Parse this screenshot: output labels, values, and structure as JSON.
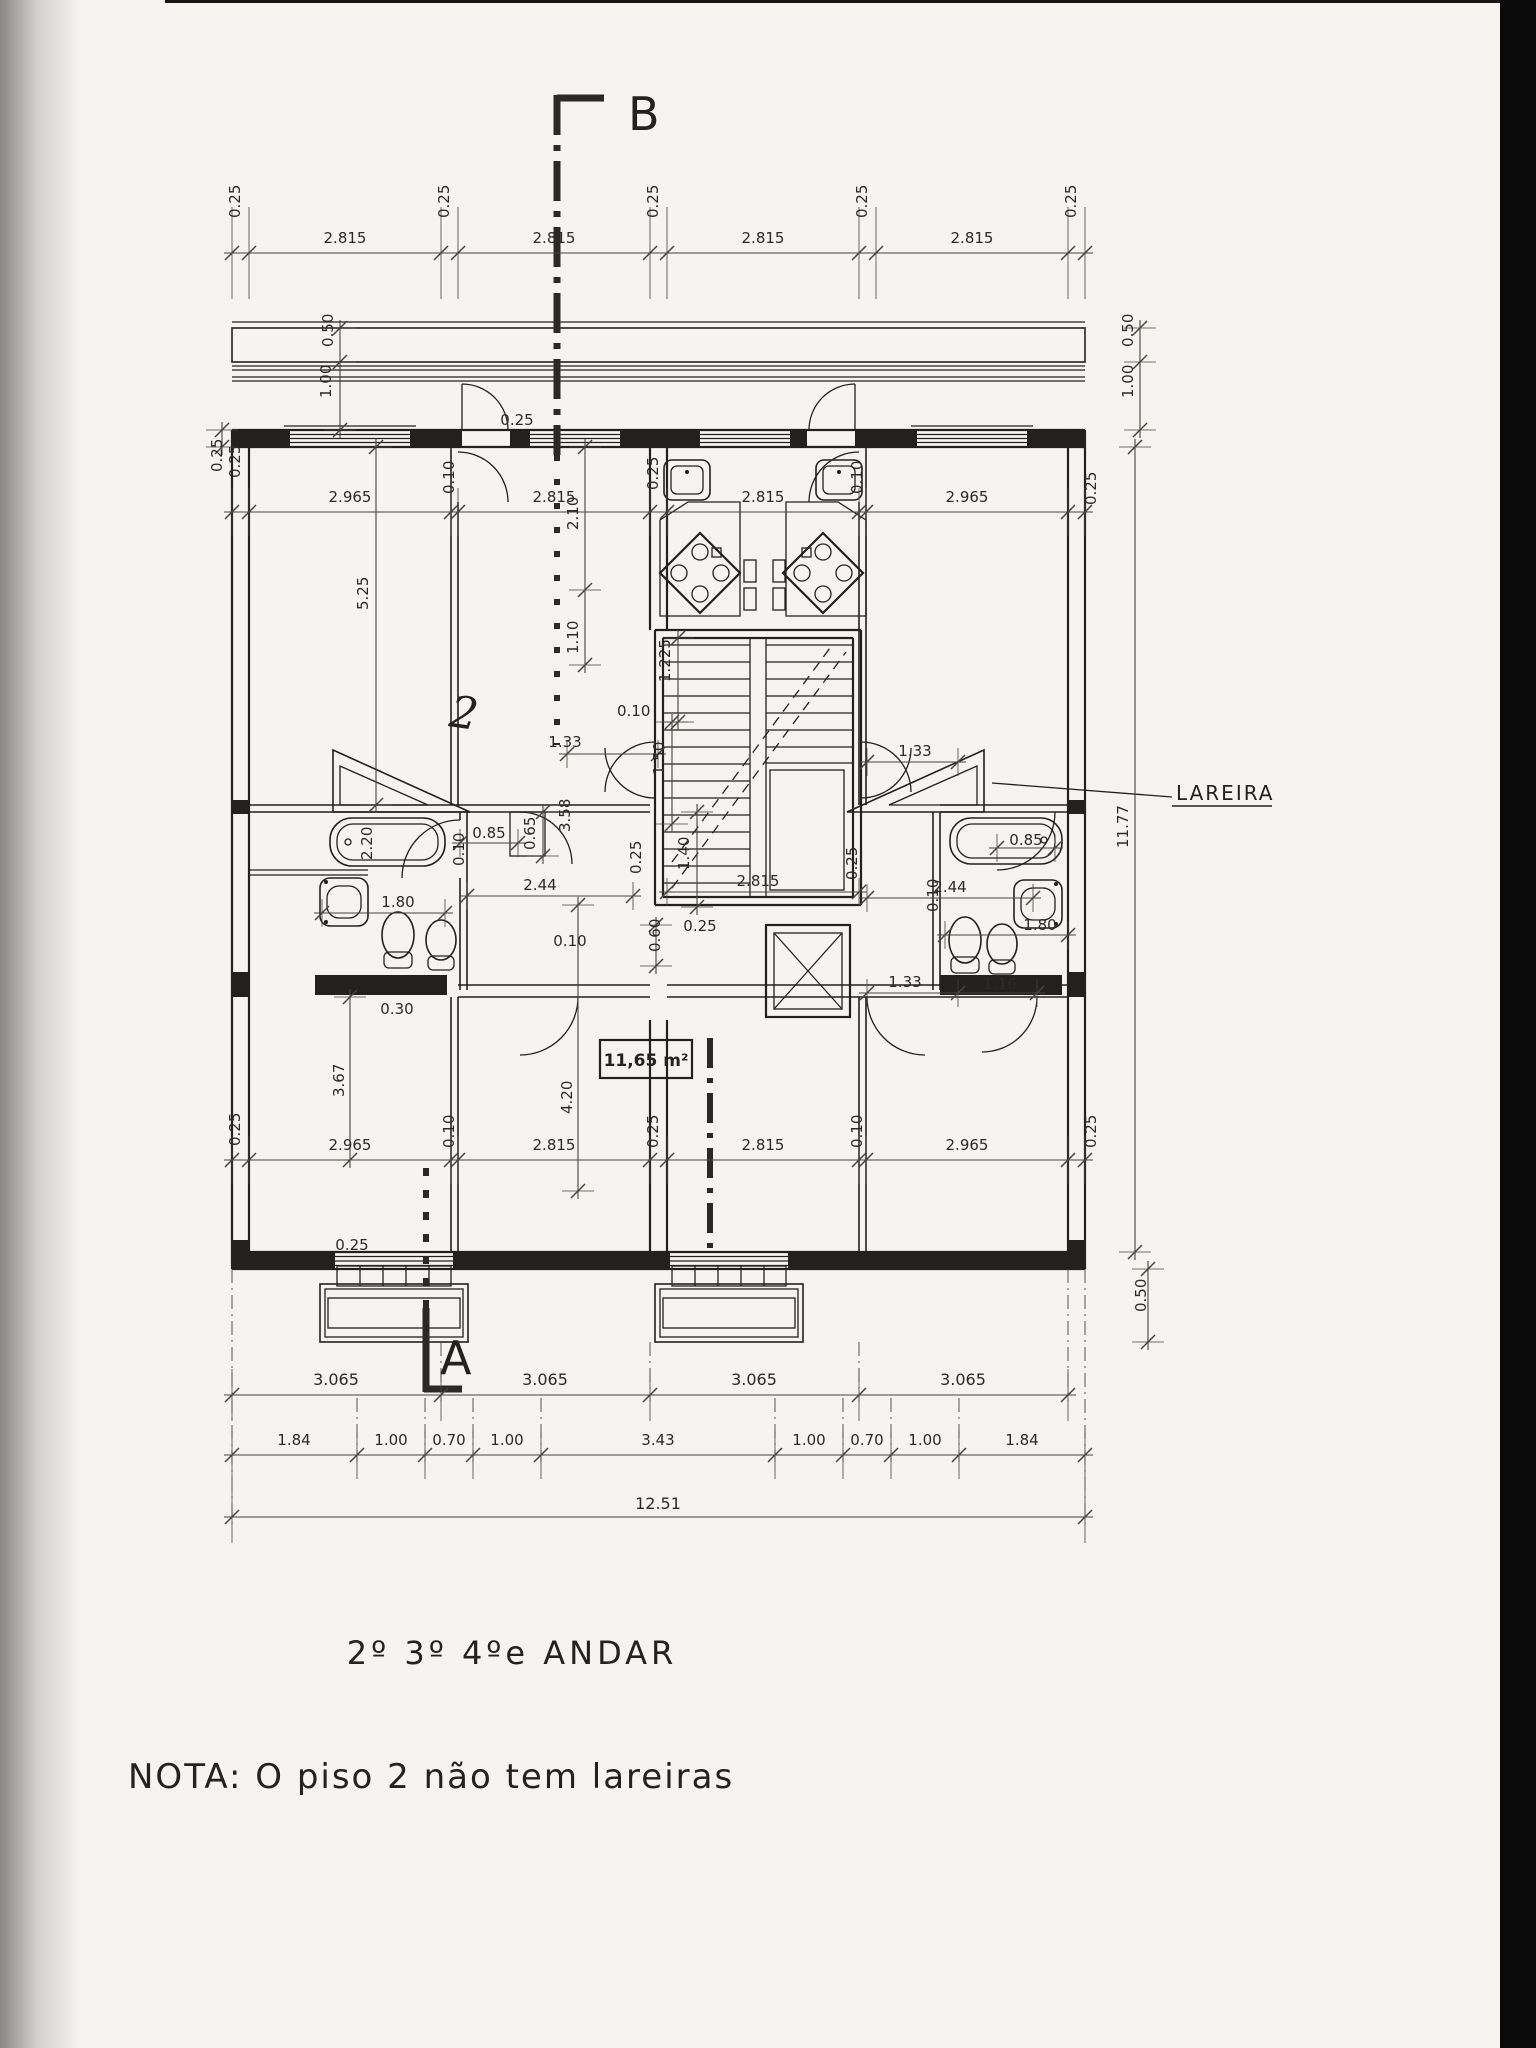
{
  "texts": {
    "title": "2º 3º 4ºe ANDAR",
    "note": "NOTA: O  piso 2  não  tem  lareiras",
    "lareira": "LAREIRA",
    "area": "11,65 m²",
    "section_a": "A",
    "section_b": "B",
    "sketch": "2"
  },
  "dims": {
    "top_row": [
      "0.25",
      "2.815",
      "0.25",
      "2.815",
      "0.25",
      "2.815",
      "0.25",
      "2.815",
      "0.25"
    ],
    "upper_row": [
      "0.25",
      "2.965",
      "0.10",
      "2.815",
      "0.25",
      "2.815",
      "0.10",
      "2.965",
      "0.25"
    ],
    "lower_row": [
      "0.25",
      "2.965",
      "0.10",
      "2.815",
      "0.25",
      "2.815",
      "0.10",
      "2.965",
      "0.25"
    ],
    "axis_row": [
      "3.065",
      "3.065",
      "3.065",
      "3.065"
    ],
    "detail_row": [
      "1.84",
      "1.00",
      "0.70",
      "1.00",
      "3.43",
      "1.00",
      "0.70",
      "1.00",
      "1.84"
    ],
    "total": "12.51",
    "vertical_left": {
      "eave": "0.50",
      "balcony": "1.00",
      "wall": "0.25",
      "room": "5.25"
    },
    "vertical_right": {
      "eave": "0.50",
      "balcony": "1.00",
      "total": "11.77",
      "south": "0.50"
    },
    "stair": {
      "d210": "2.10",
      "d110": "1.10",
      "d010a": "0.10",
      "d1225": "1.225",
      "d150": "1.50",
      "d140": "1.40",
      "d025a": "0.25",
      "d025b": "0.25",
      "d2815": "2.815",
      "d025w": "0.25",
      "d060": "0.60",
      "d010b": "0.10",
      "d358": "3.58",
      "d133l": "1.33",
      "d133r": "1.33"
    },
    "wall_callouts": {
      "top": "0.25"
    },
    "bath_left": {
      "tub": "2.20",
      "door": "0.85",
      "d065": "0.65",
      "d010": "0.10",
      "d244": "2.44",
      "basin": "1.80",
      "wall": "0.30"
    },
    "bath_right": {
      "door": "0.85",
      "d244": "2.44",
      "d010": "0.10",
      "basin": "1.80",
      "d133": "1.33",
      "d116": "1.16"
    },
    "lower": {
      "d367": "3.67",
      "d420": "4.20",
      "wall": "0.25"
    }
  },
  "colors": {
    "ink": "#22211e",
    "paper": "#f5f4f0",
    "scan_bar": "#0b0b0b"
  }
}
